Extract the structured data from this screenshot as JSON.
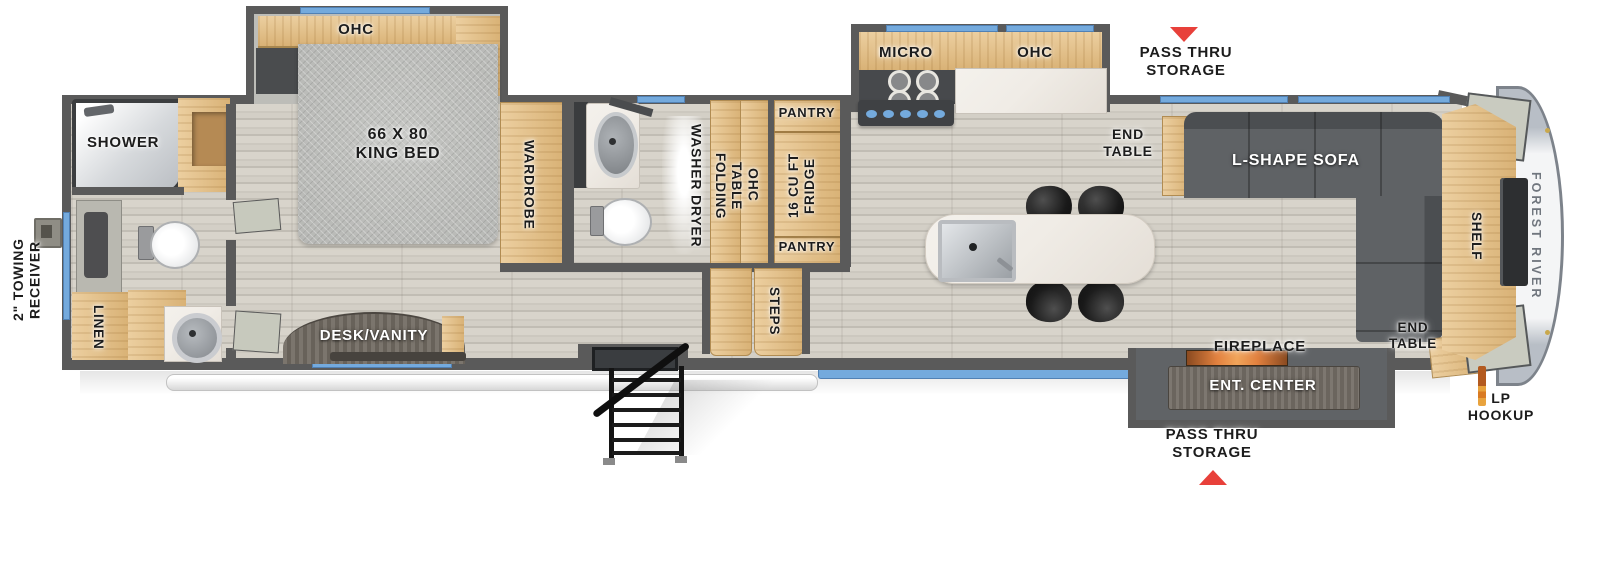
{
  "colors": {
    "wall": "#5a5a5a",
    "wood": "#eccfa0",
    "wood-dark": "#d9b276",
    "floor-a": "#d8d4cb",
    "floor-b": "#c1bdb4",
    "accent-blue": "#74aadd",
    "arrow-red": "#e8403a",
    "sofa": "#5f6265",
    "bed-gray": "#b7b8b5",
    "marble": "#f0ece6",
    "cap-gray": "#b8bec6"
  },
  "labels": {
    "towing_l1": "2\" TOWING",
    "towing_l2": "RECEIVER",
    "shower": "SHOWER",
    "linen": "LINEN",
    "ohc_bedroom": "OHC",
    "bed_l1": "66 X 80",
    "bed_l2": "KING BED",
    "wardrobe": "WARDROBE",
    "desk_vanity": "DESK/VANITY",
    "washer_dryer": "WASHER DRYER",
    "folding_l1": "FOLDING",
    "folding_l2": "TABLE",
    "ohc_hall": "OHC",
    "pantry_top": "PANTRY",
    "fridge_l1": "16 CU FT",
    "fridge_l2": "FRIDGE",
    "pantry_bottom": "PANTRY",
    "steps": "STEPS",
    "micro": "MICRO",
    "ohc_kitchen": "OHC",
    "end_table_top_l1": "END",
    "end_table_top_l2": "TABLE",
    "sofa": "L-SHAPE SOFA",
    "pass_thru_top_l1": "PASS THRU",
    "pass_thru_top_l2": "STORAGE",
    "shelf": "SHELF",
    "brand": "FOREST RIVER",
    "end_table_bottom_l1": "END",
    "end_table_bottom_l2": "TABLE",
    "fireplace": "FIREPLACE",
    "ent_center": "ENT. CENTER",
    "pass_thru_bottom_l1": "PASS THRU",
    "pass_thru_bottom_l2": "STORAGE",
    "lp_l1": "LP",
    "lp_l2": "HOOKUP"
  }
}
